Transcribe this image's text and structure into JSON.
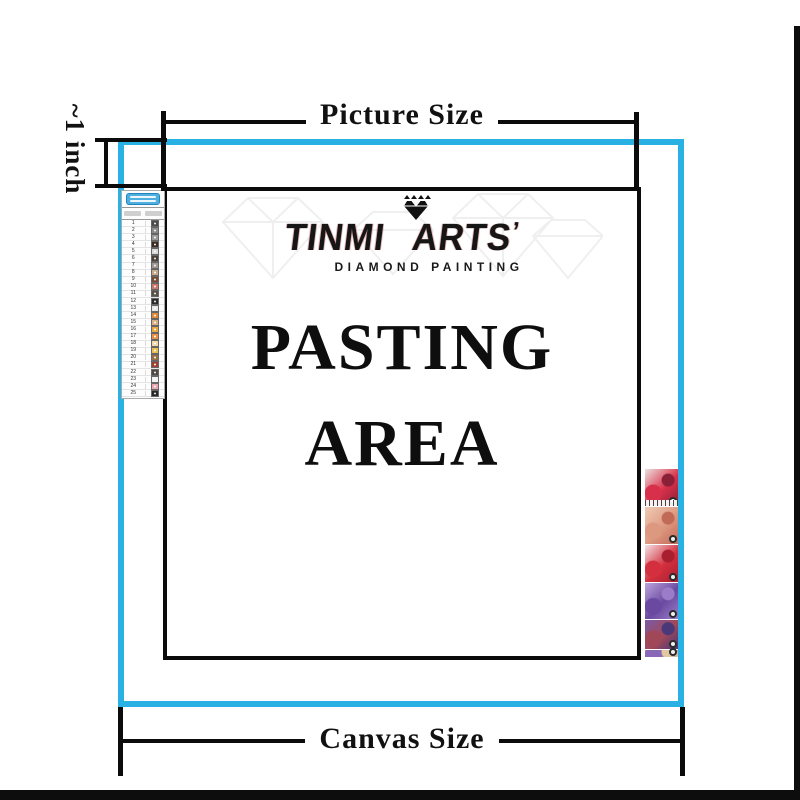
{
  "labels": {
    "picture_size": "Picture Size",
    "canvas_size": "Canvas Size",
    "inch": "~1 inch",
    "pasting_line1": "PASTING",
    "pasting_line2": "AREA"
  },
  "logo": {
    "brand": "TINMI ARTS",
    "brand_mark": "’",
    "subtitle": "DIAMOND PAINTING"
  },
  "colors": {
    "canvas_border": "#29b1e3",
    "dimension_line": "#0b0b0b",
    "chart_header_bg": "#4fb0e0"
  },
  "color_chart": {
    "rows": [
      {
        "no": "1",
        "color": "#4a4a4a"
      },
      {
        "no": "2",
        "color": "#8a8a8a"
      },
      {
        "no": "3",
        "color": "#9a9a9a"
      },
      {
        "no": "4",
        "color": "#3a2a22"
      },
      {
        "no": "5",
        "color": "#d8d8d8"
      },
      {
        "no": "6",
        "color": "#4a4038"
      },
      {
        "no": "7",
        "color": "#a09890"
      },
      {
        "no": "8",
        "color": "#c8a888"
      },
      {
        "no": "9",
        "color": "#7a4a32"
      },
      {
        "no": "10",
        "color": "#c87868"
      },
      {
        "no": "11",
        "color": "#5a5248"
      },
      {
        "no": "12",
        "color": "#2a2a2a"
      },
      {
        "no": "13",
        "color": "#e8e8e8"
      },
      {
        "no": "14",
        "color": "#e08838"
      },
      {
        "no": "15",
        "color": "#d8b088"
      },
      {
        "no": "16",
        "color": "#e8a840"
      },
      {
        "no": "17",
        "color": "#e89048"
      },
      {
        "no": "18",
        "color": "#f0d8a8"
      },
      {
        "no": "19",
        "color": "#e8c050"
      },
      {
        "no": "20",
        "color": "#987048"
      },
      {
        "no": "21",
        "color": "#a04030"
      },
      {
        "no": "22",
        "color": "#504840"
      },
      {
        "no": "23",
        "color": "#f2f2f2"
      },
      {
        "no": "24",
        "color": "#e8a8b0"
      },
      {
        "no": "25",
        "color": "#282828"
      }
    ]
  },
  "thumbnails": {
    "items": [
      {
        "name": "red-floral-kit",
        "c1": "#ece2de",
        "c2": "#d8304a",
        "c3": "#8a2038",
        "height": 38,
        "symbols": true
      },
      {
        "name": "peach-feather-kit",
        "c1": "#f0cbb4",
        "c2": "#dd9880",
        "c3": "#c26a58",
        "height": 38,
        "symbols": false
      },
      {
        "name": "red-shirt-kit",
        "c1": "#f3e2e4",
        "c2": "#d42f3e",
        "c3": "#a81f30",
        "height": 38,
        "symbols": false
      },
      {
        "name": "purple-feather-kit",
        "c1": "#bca4dc",
        "c2": "#6a4aa0",
        "c3": "#9a7cc8",
        "height": 37,
        "symbols": false
      },
      {
        "name": "purple-red-kit",
        "c1": "#7a5aa8",
        "c2": "#a04858",
        "c3": "#4a3878",
        "height": 30,
        "symbols": false
      },
      {
        "name": "tan-sticks-kit",
        "c1": "#c8a070",
        "c2": "#8a68b8",
        "c3": "#e0c8a0",
        "height": 8,
        "symbols": false
      }
    ]
  }
}
